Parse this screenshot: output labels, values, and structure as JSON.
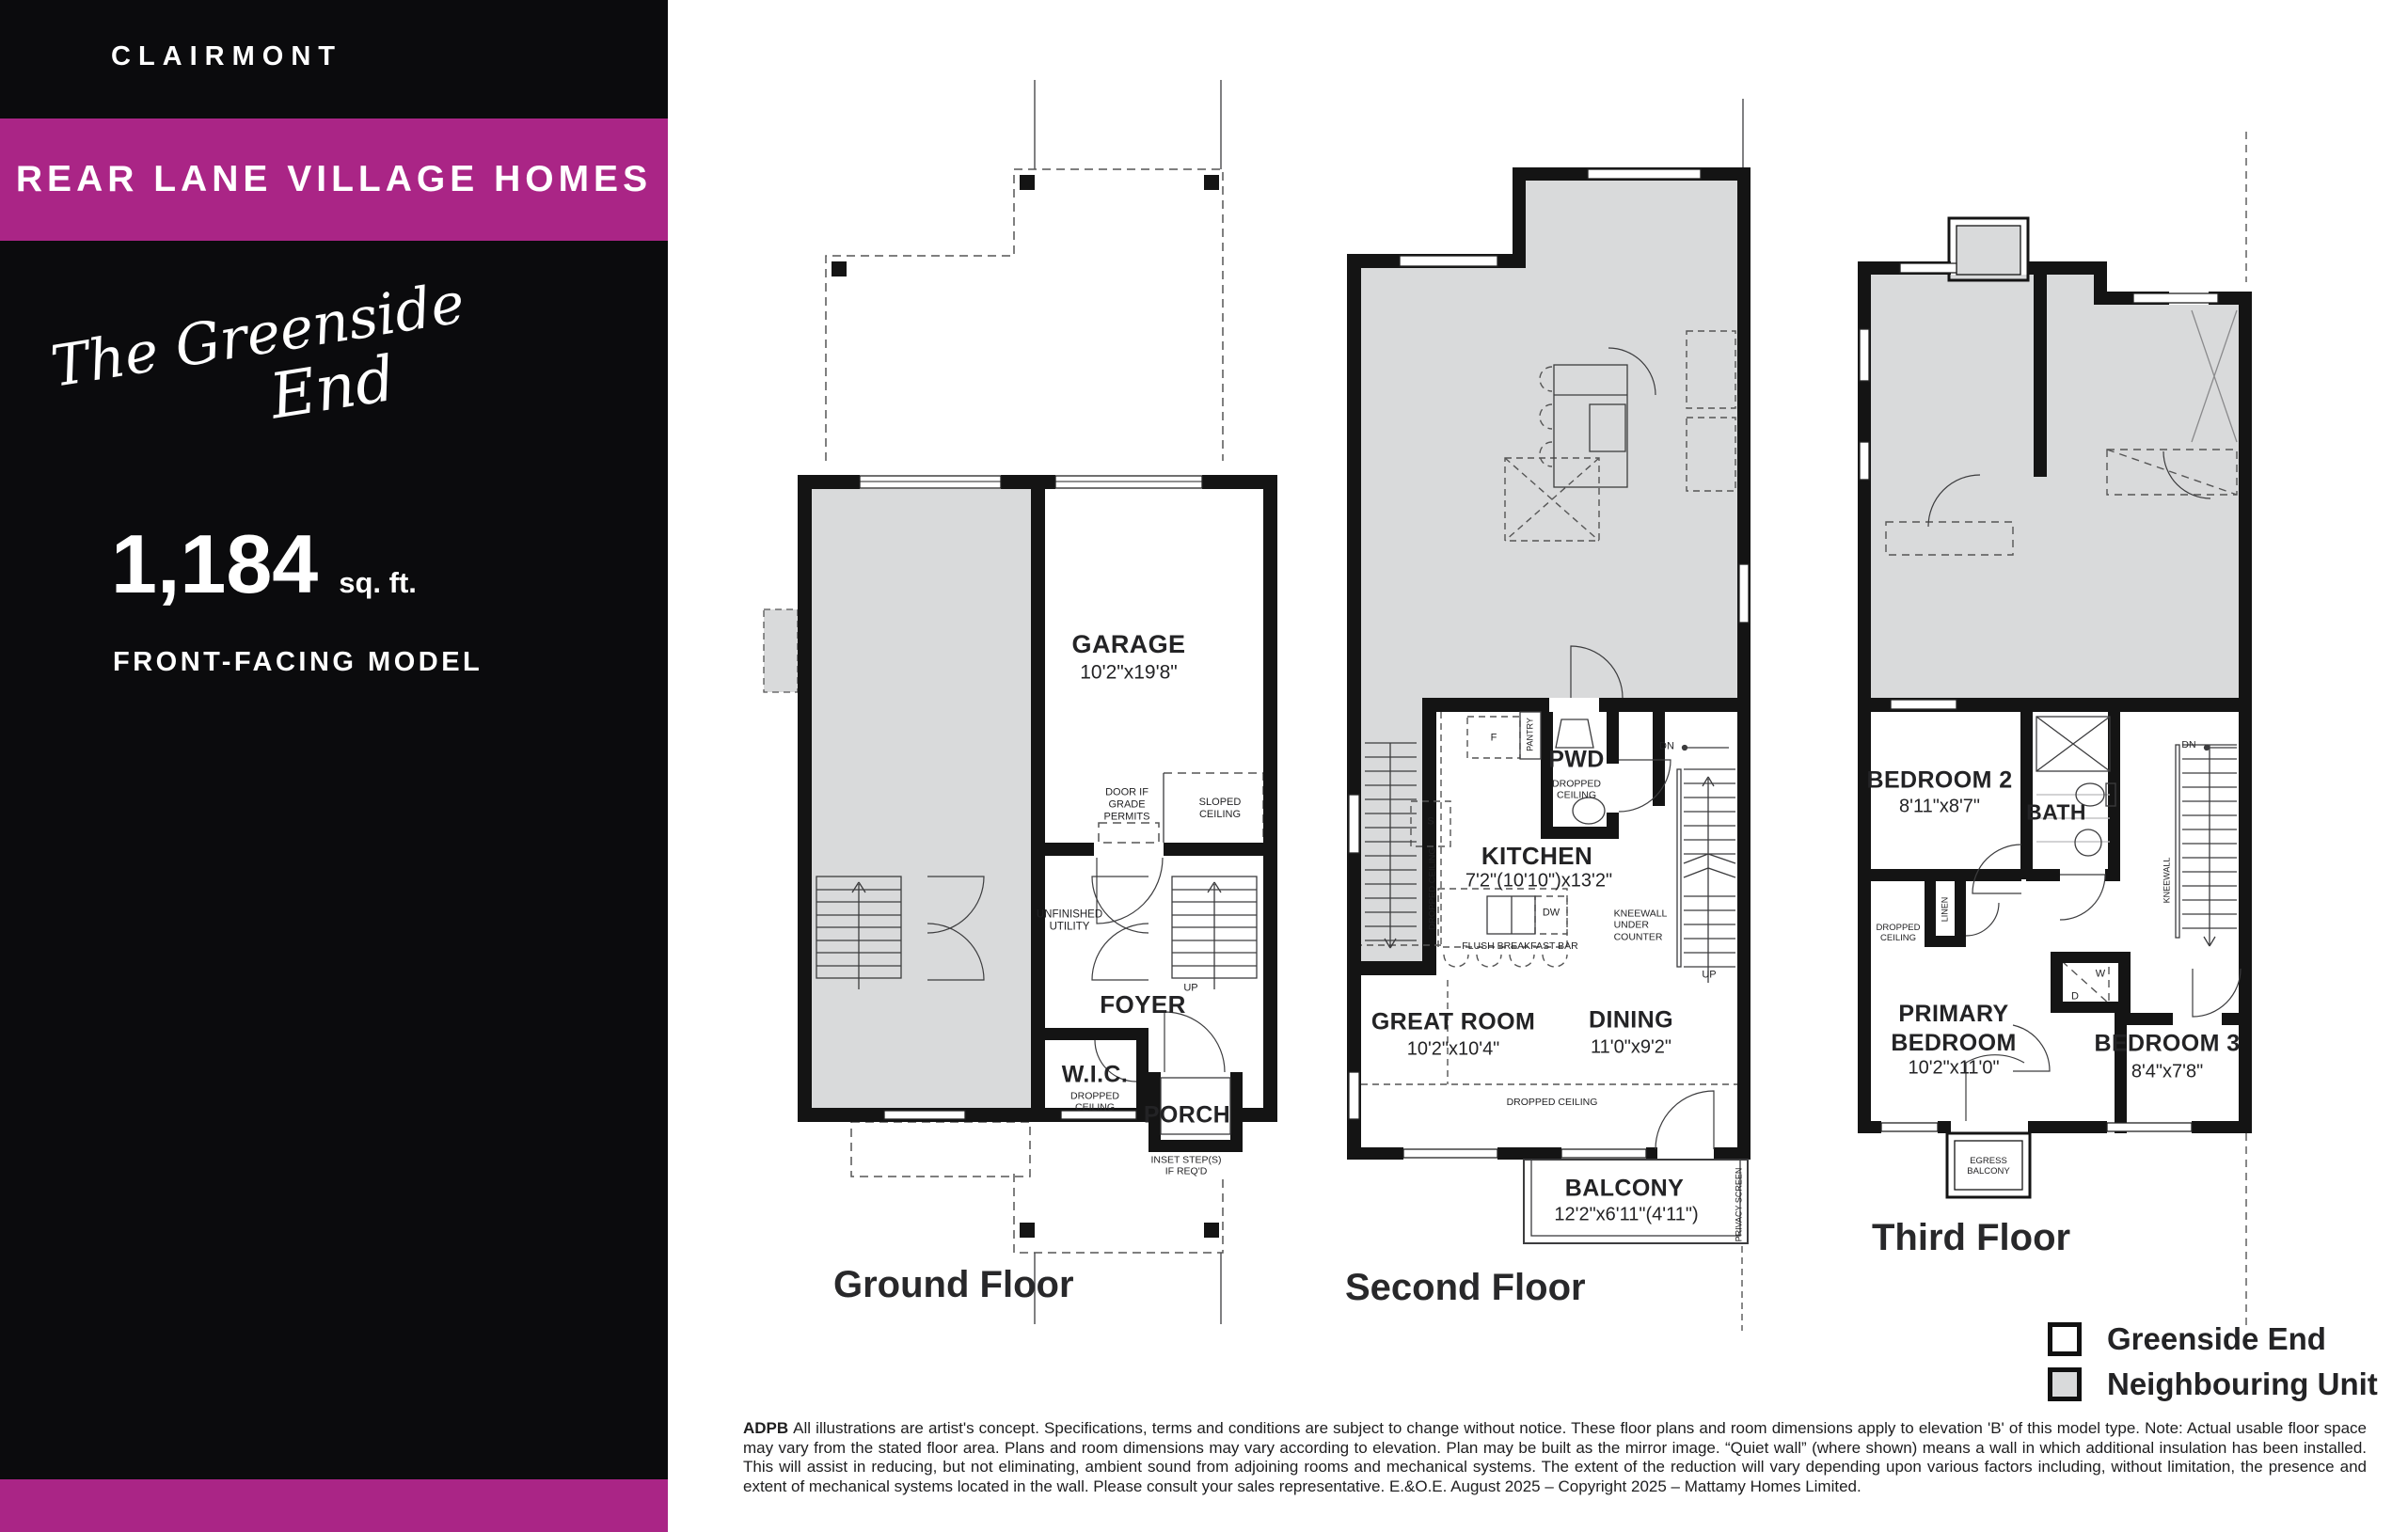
{
  "sidebar": {
    "community": "CLAIRMONT",
    "banner": "REAR LANE VILLAGE HOMES",
    "model_name_line1": "The Greenside",
    "model_name_line2": "End",
    "sqft_value": "1,184",
    "sqft_unit": "sq. ft.",
    "model_type": "FRONT-FACING MODEL"
  },
  "colors": {
    "accent_magenta": "#AA2586",
    "sidebar_black": "#0B0B0D",
    "neighbour_fill": "#D9DADB"
  },
  "plans": {
    "ground": {
      "caption": "Ground Floor",
      "labels": {
        "garage": "GARAGE",
        "garage_dims": "10'2\"x19'8\"",
        "door_note": "DOOR IF\nGRADE\nPERMITS",
        "sloped": "SLOPED\nCEILING",
        "utility": "UNFINISHED\nUTILITY",
        "foyer": "FOYER",
        "up": "UP",
        "wic": "W.I.C.",
        "wic_note": "DROPPED\nCEILING",
        "porch": "PORCH",
        "inset": "INSET STEP(S)\nIF REQ'D"
      }
    },
    "second": {
      "caption": "Second Floor",
      "labels": {
        "pantry": "PANTRY",
        "fridge": "F",
        "pwd": "PWD",
        "pwd_note": "DROPPED\nCEILING",
        "dn": "DN",
        "sink": "S",
        "dropped_vert": "DROPPED CEILING",
        "kitchen": "KITCHEN",
        "kitchen_dims": "7'2\"(10'10\")x13'2\"",
        "dw": "DW",
        "flush_bar": "FLUSH BREAKFAST BAR",
        "kneewall": "KNEEWALL\nUNDER\nCOUNTER",
        "up": "UP",
        "great": "GREAT ROOM",
        "great_dims": "10'2\"x10'4\"",
        "dining": "DINING",
        "dining_dims": "11'0\"x9'2\"",
        "dropped": "DROPPED CEILING",
        "balcony": "BALCONY",
        "balcony_dims": "12'2\"x6'11\"(4'11\")",
        "privacy": "PRIVACY SCREEN"
      }
    },
    "third": {
      "caption": "Third Floor",
      "labels": {
        "bed2": "BEDROOM 2",
        "bed2_dims": "8'11\"x8'7\"",
        "bath": "BATH",
        "dn": "DN",
        "kneewall": "KNEEWALL",
        "linen": "LINEN",
        "dropped": "DROPPED\nCEILING",
        "washer": "W",
        "dryer": "D",
        "primary": "PRIMARY\nBEDROOM",
        "primary_dims": "10'2\"x11'0\"",
        "bed3": "BEDROOM 3",
        "bed3_dims": "8'4\"x7'8\"",
        "egress": "EGRESS\nBALCONY"
      }
    }
  },
  "legend": {
    "items": [
      {
        "label": "Greenside End"
      },
      {
        "label": "Neighbouring Unit"
      }
    ]
  },
  "disclaimer": {
    "prefix": "ADPB",
    "body": "All illustrations are artist's concept. Specifications, terms and conditions are subject to change without notice. These floor plans and room dimensions apply to elevation 'B' of this model type. Note: Actual usable floor space may vary from the stated floor area. Plans and room dimensions may vary according to elevation. Plan may be built as the mirror image. “Quiet wall” (where shown) means a wall in which additional insulation has been installed. This will assist in reducing, but not eliminating, ambient sound from adjoining rooms and mechanical systems. The extent of the reduction will vary depending upon various factors including, without limitation, the presence and extent of mechanical systems located in the wall. Please consult your sales representative. E.&O.E. August 2025 – Copyright 2025 – Mattamy Homes Limited."
  }
}
